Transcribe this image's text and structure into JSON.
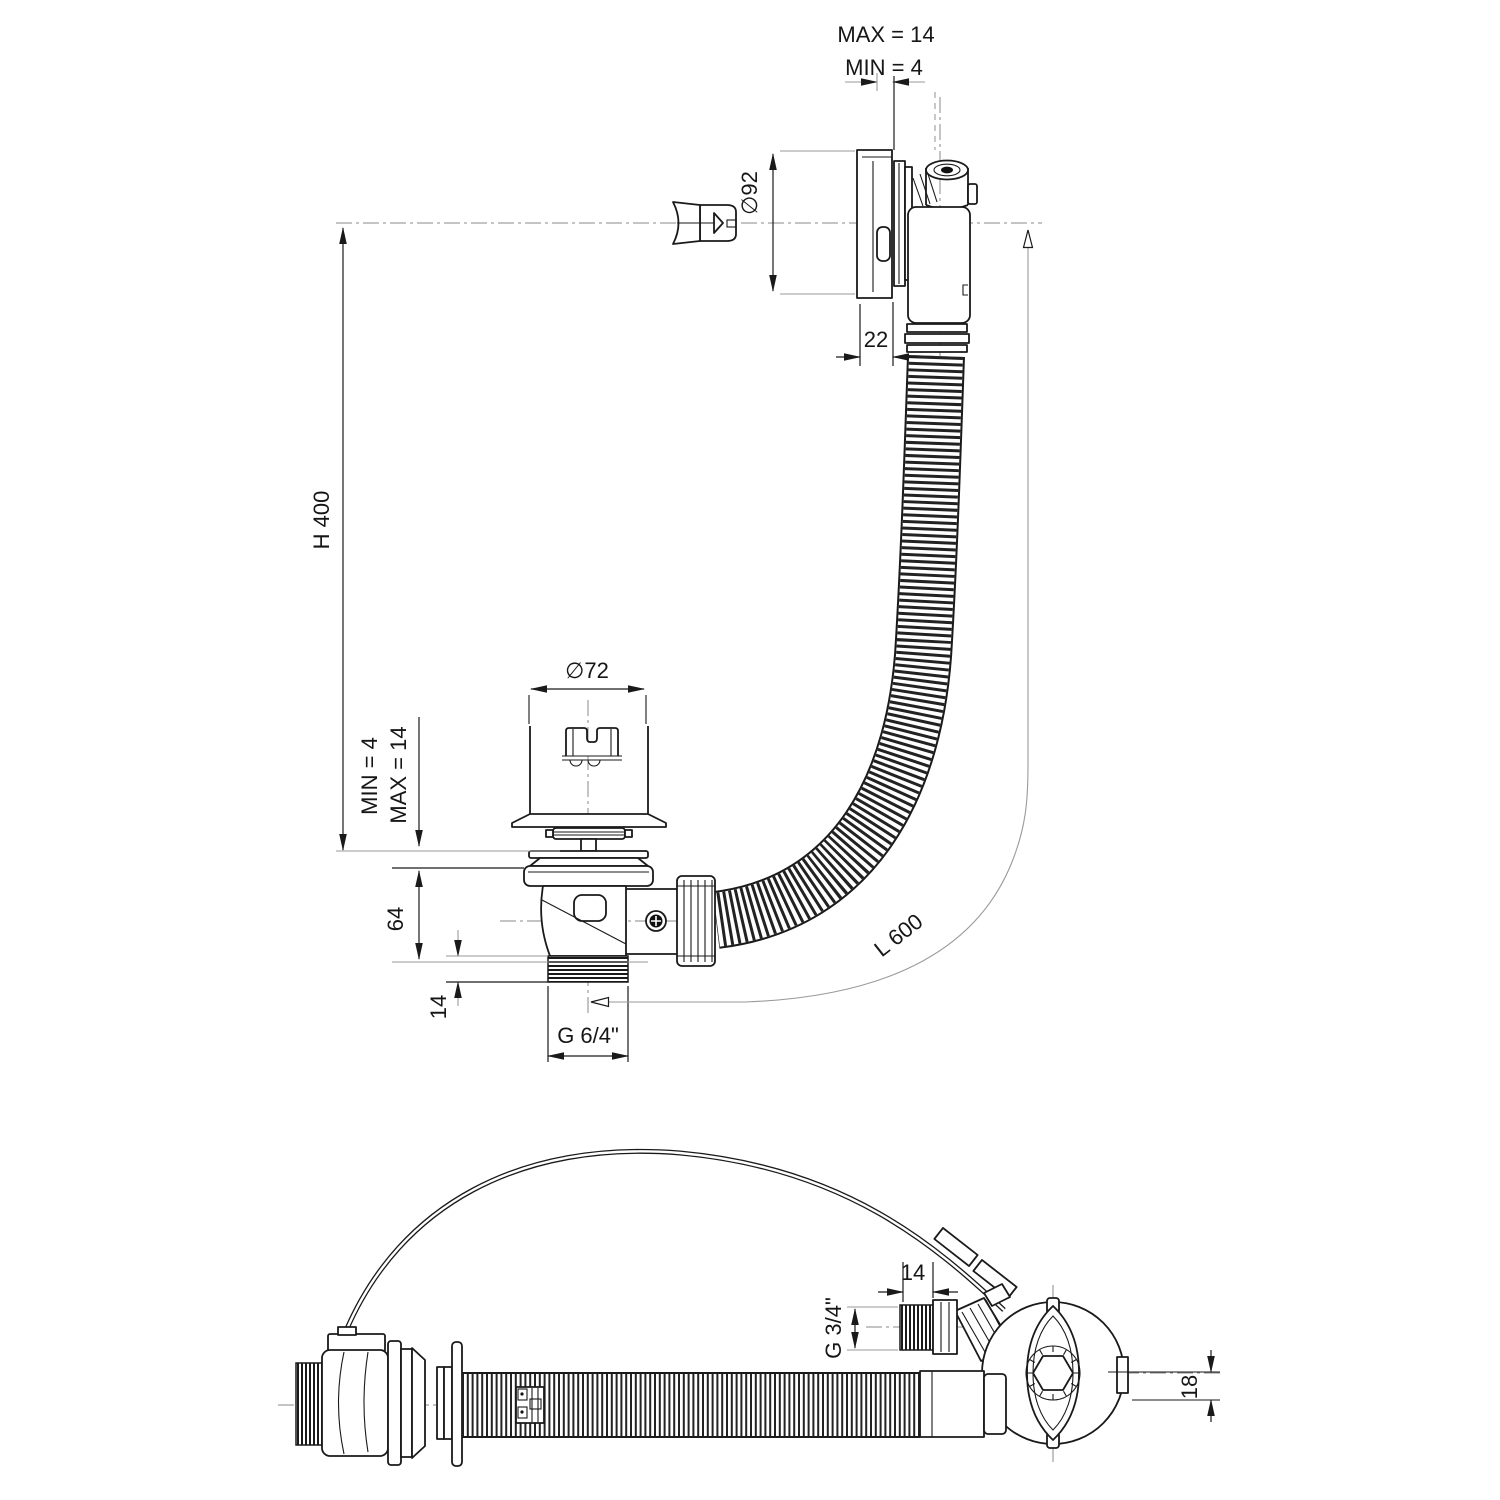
{
  "drawing": {
    "type": "technical-dimension-drawing",
    "subject": "bath-waste-overflow-drain-kit",
    "upper_view": {
      "top_clamp": {
        "max_label": "MAX = 14",
        "min_label": "MIN = 4"
      },
      "overflow_diameter_label": "∅92",
      "overflow_depth_label": "22",
      "height_label": "H 400",
      "plug_diameter_label": "∅72",
      "plug_clamp": {
        "min_label": "MIN = 4",
        "max_label": "MAX = 14"
      },
      "drain_body_height_label": "64",
      "drain_thread_length_label": "14",
      "drain_thread_size_label": "G 6/4\"",
      "hose_length_label": "L 600"
    },
    "lower_view": {
      "overflow_thread_length_label": "14",
      "overflow_thread_size_label": "G 3/4\"",
      "hose_axis_offset_label": "18"
    },
    "colors": {
      "line": "#1a1a1a",
      "extension": "#9a9a9a",
      "centerline": "#8a8a8a",
      "background": "#ffffff"
    }
  }
}
